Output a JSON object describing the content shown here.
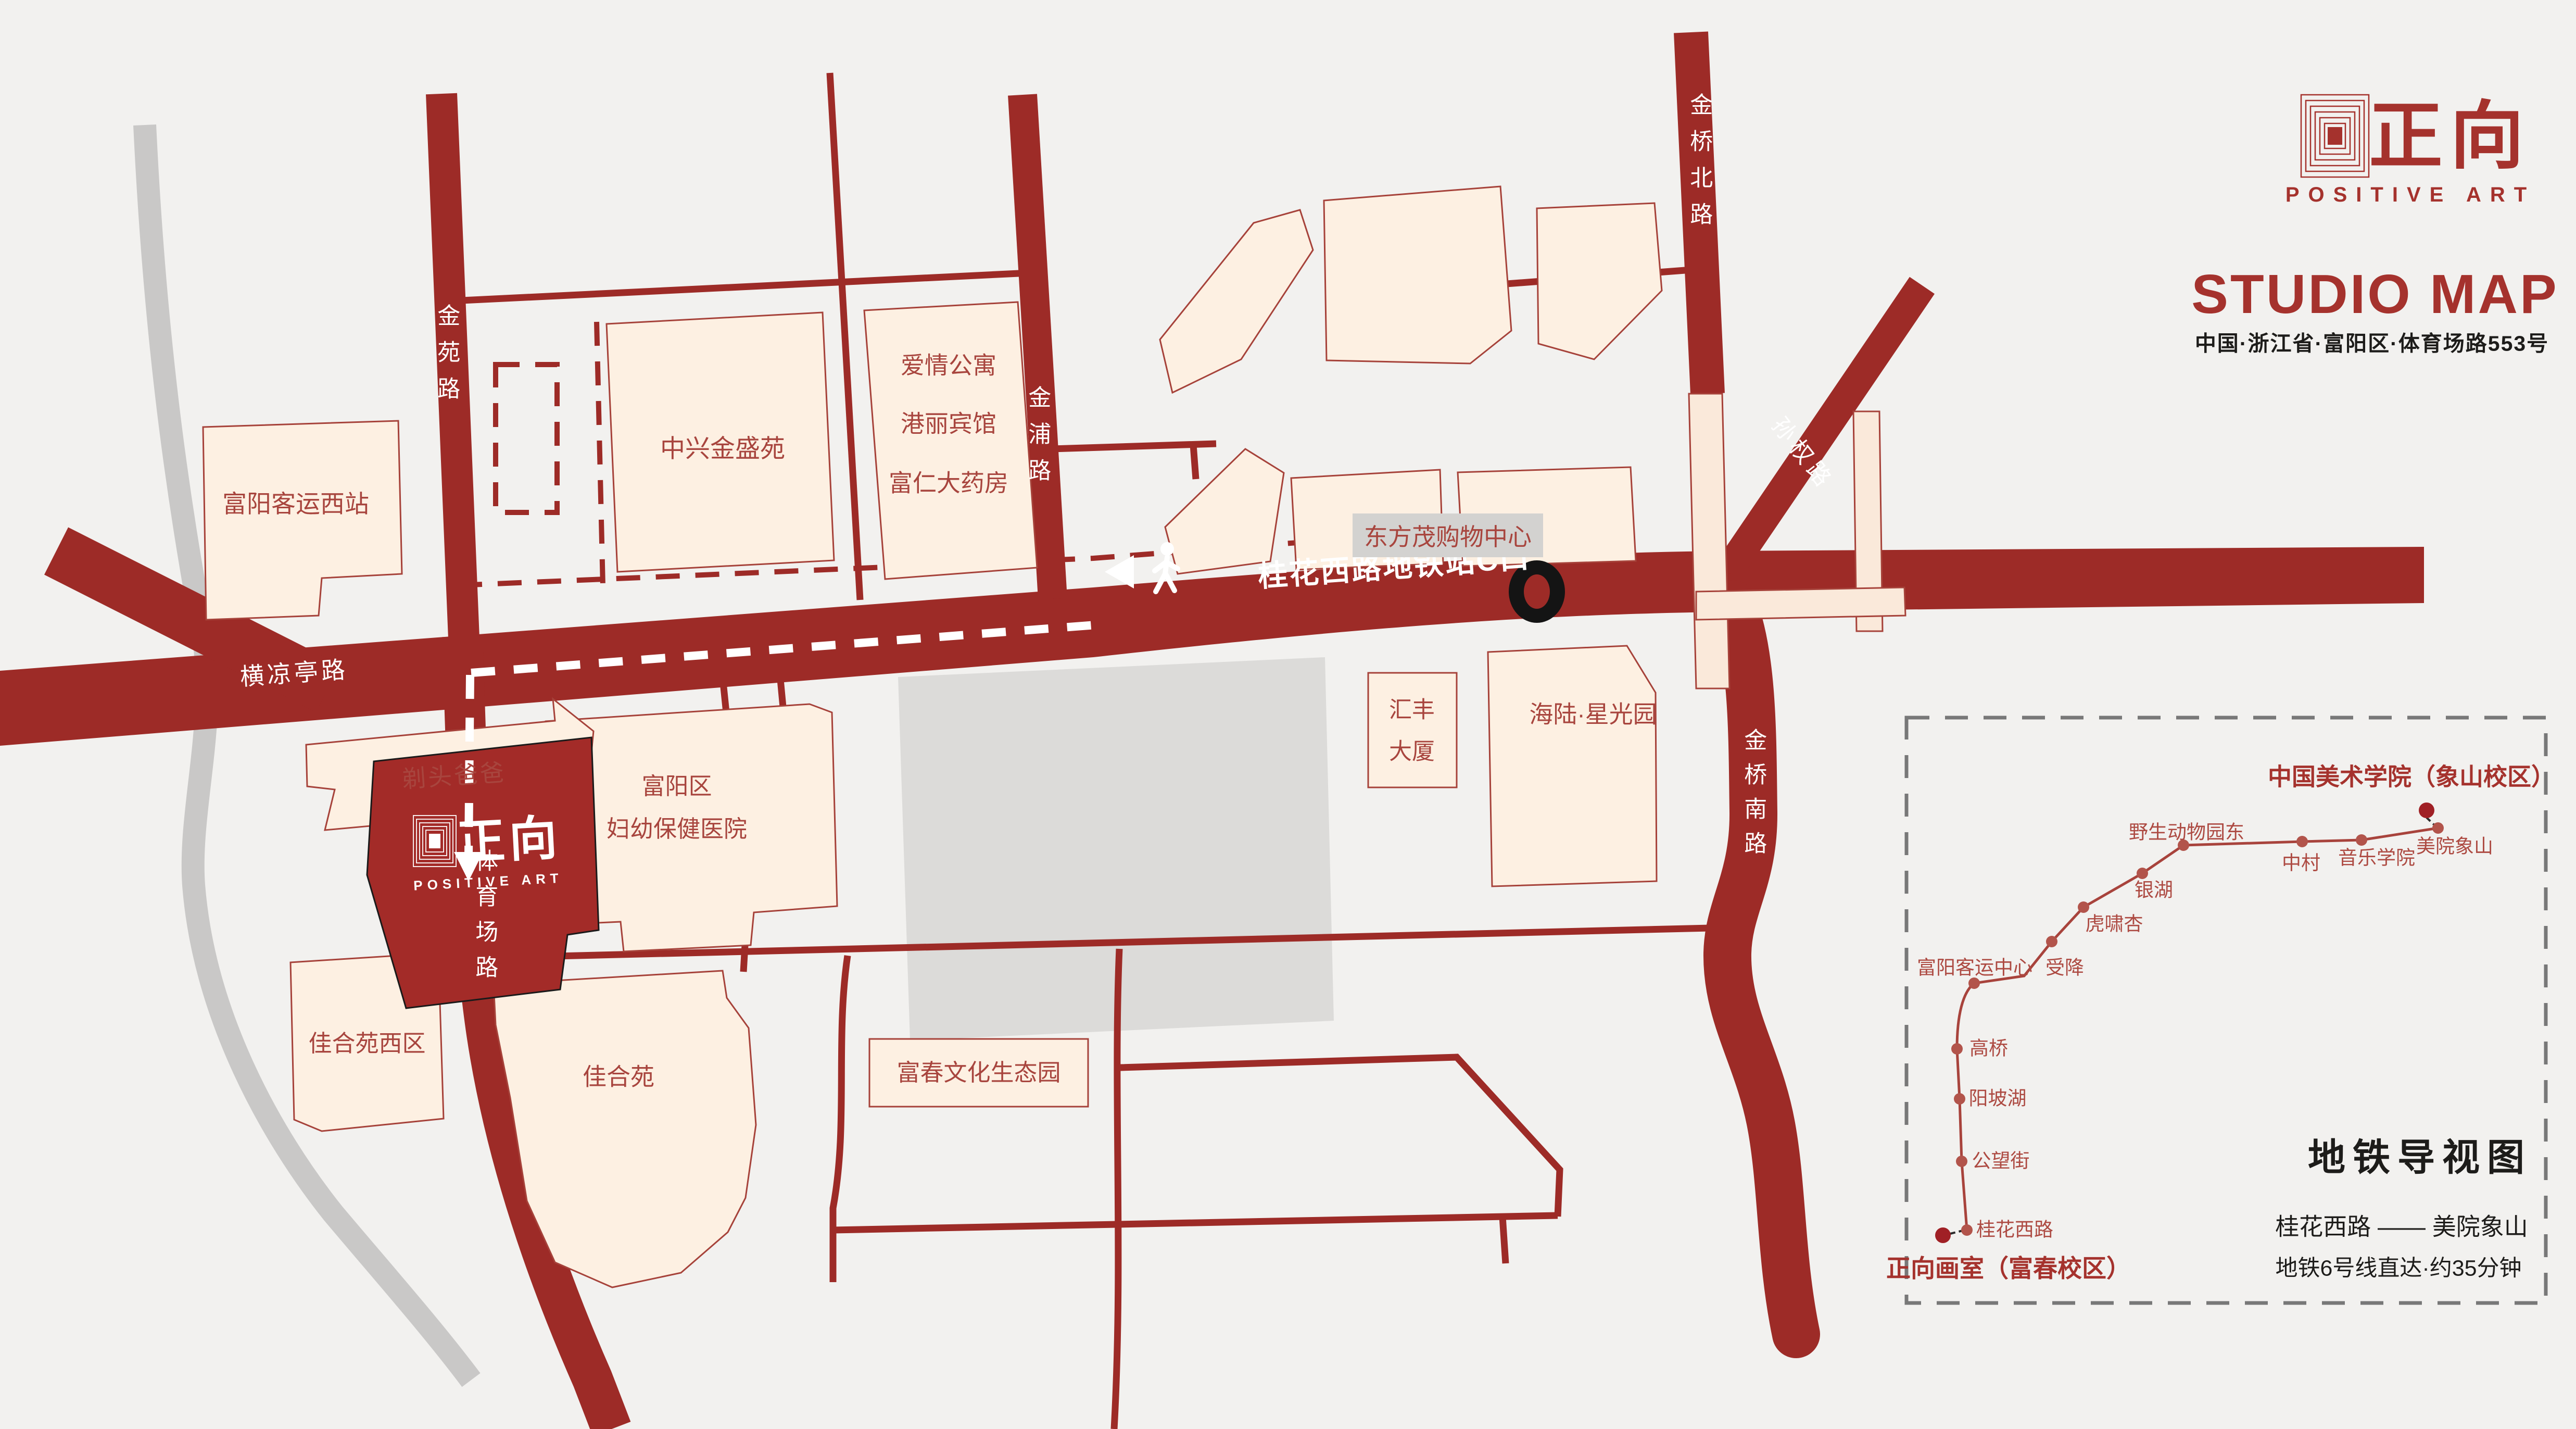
{
  "header": {
    "logo_text": "正向",
    "logo_subtext": "POSITIVE ART",
    "title": "STUDIO MAP",
    "address": "中国·浙江省·富阳区·体育场路553号"
  },
  "colors": {
    "background": "#f2f1ef",
    "road_red": "#9d2b27",
    "building_fill": "#fdf0e2",
    "building_stroke": "#a6423a",
    "accent_red": "#a5322d",
    "label_red": "#a8453e",
    "gray_road": "#c9c8c7",
    "gray_block": "#dcdbd9",
    "gray_label_bg": "#d3d2d0",
    "metro_line": "#a8433c",
    "metro_dot": "#b2544b",
    "metro_terminal": "#a02025",
    "text_black": "#1d1c1a"
  },
  "roads": {
    "jinyuan": "金苑路",
    "jinpu": "金浦路",
    "jinqiao_north": "金桥北路",
    "sunquan": "孙权路",
    "hengliangting": "横凉亭路",
    "tiyuchang": "体育场路",
    "jinqiao_south": "金桥南路"
  },
  "route": {
    "station_exit_label": "桂花西路地铁站C口",
    "icons": {
      "walk": "walking-person-icon",
      "arrow": "left-arrow-icon",
      "exit_marker": "metro-exit-marker"
    }
  },
  "buildings": {
    "west_bus_station": "富阳客运西站",
    "zhongxing": "中兴金盛苑",
    "apartment_line1": "爱情公寓",
    "apartment_line2": "港丽宾馆",
    "apartment_line3": "富仁大药房",
    "dongfangmao": "东方茂购物中心",
    "huifeng_line1": "汇丰",
    "huifeng_line2": "大厦",
    "hailu": "海陆·星光园",
    "hospital_line1": "富阳区",
    "hospital_line2": "妇幼保健医院",
    "titou": "剃头爸爸",
    "jiaheyuan_west": "佳合苑西区",
    "jiaheyuan": "佳合苑",
    "fuchun_park": "富春文化生态园",
    "studio_logo_text": "正向",
    "studio_logo_subtext": "POSITIVE ART"
  },
  "metro": {
    "panel_title": "地铁导视图",
    "route_summary": "桂花西路 —— 美院象山",
    "duration_note": "地铁6号线直达·约35分钟",
    "origin_label": "正向画室（富春校区）",
    "terminus_label": "中国美术学院（象山校区）",
    "stations": [
      {
        "name": "桂花西路"
      },
      {
        "name": "公望街"
      },
      {
        "name": "阳坡湖"
      },
      {
        "name": "高桥"
      },
      {
        "name": "富阳客运中心"
      },
      {
        "name": "受降"
      },
      {
        "name": "虎啸杏"
      },
      {
        "name": "银湖"
      },
      {
        "name": "野生动物园东"
      },
      {
        "name": "中村"
      },
      {
        "name": "音乐学院"
      },
      {
        "name": "美院象山"
      }
    ]
  }
}
